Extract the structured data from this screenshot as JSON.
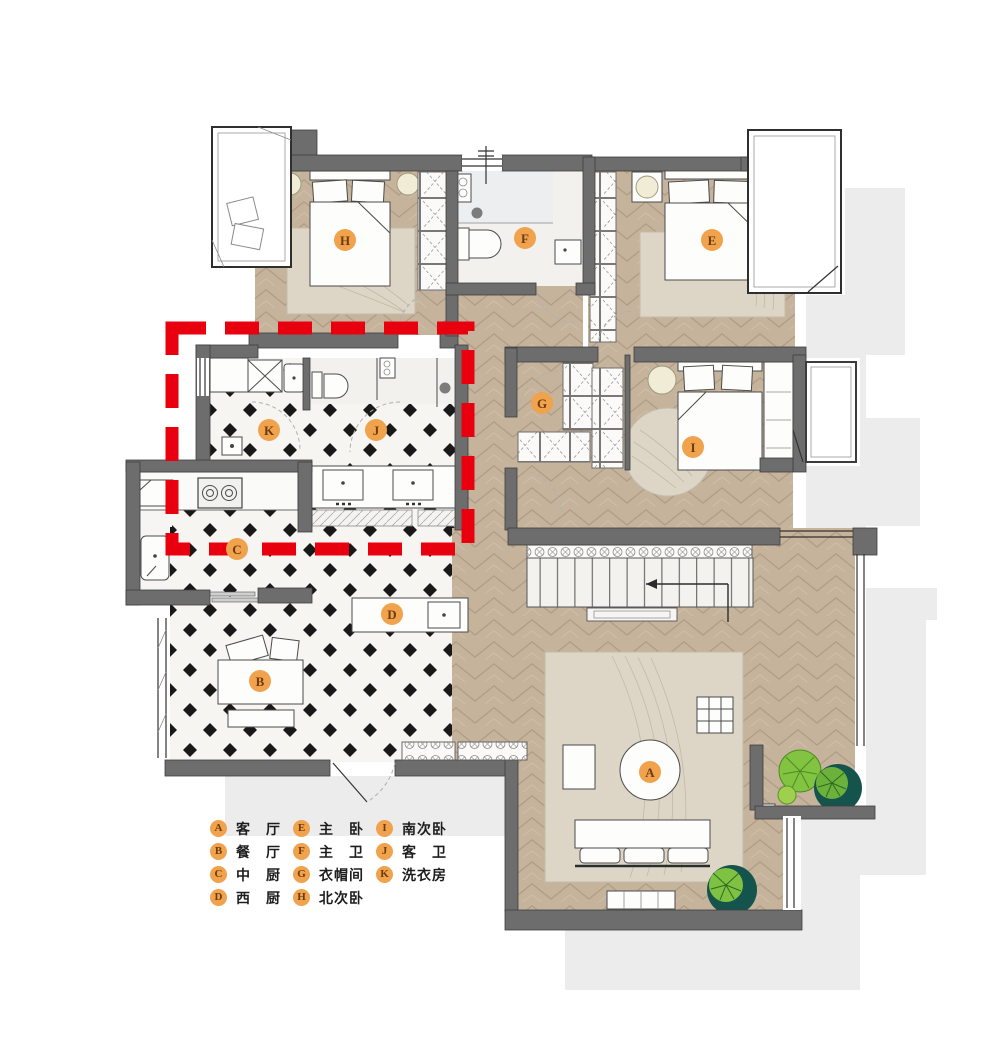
{
  "figure": {
    "type": "apartment-floor-plan",
    "highlight_note": "red dashed rectangle over west kitchen / laundry / guest bath zone"
  },
  "rooms": [
    {
      "key": "A",
      "label": "客　厅"
    },
    {
      "key": "B",
      "label": "餐　厅"
    },
    {
      "key": "C",
      "label": "中　厨"
    },
    {
      "key": "D",
      "label": "西　厨"
    },
    {
      "key": "E",
      "label": "主　卧"
    },
    {
      "key": "F",
      "label": "主　卫"
    },
    {
      "key": "G",
      "label": "衣帽间"
    },
    {
      "key": "H",
      "label": "北次卧"
    },
    {
      "key": "I",
      "label": "南次卧"
    },
    {
      "key": "J",
      "label": "客　卫"
    },
    {
      "key": "K",
      "label": "洗衣房"
    }
  ],
  "colors": {
    "wall": "#6d6d6d",
    "wood_floor": "#c6b39c",
    "tile_floor": "#f7f5f1",
    "tile_diamond": "#191919",
    "marble": "#f2f1ee",
    "rug": "#ddd6c7",
    "lamp": "#f1ecd6",
    "badge_bg": "#f0a24c",
    "badge_text": "#6b3c10",
    "highlight_red": "#e8000f",
    "plant_light": "#82c341",
    "plant_dark": "#15544c",
    "shadow": "#ececec"
  }
}
